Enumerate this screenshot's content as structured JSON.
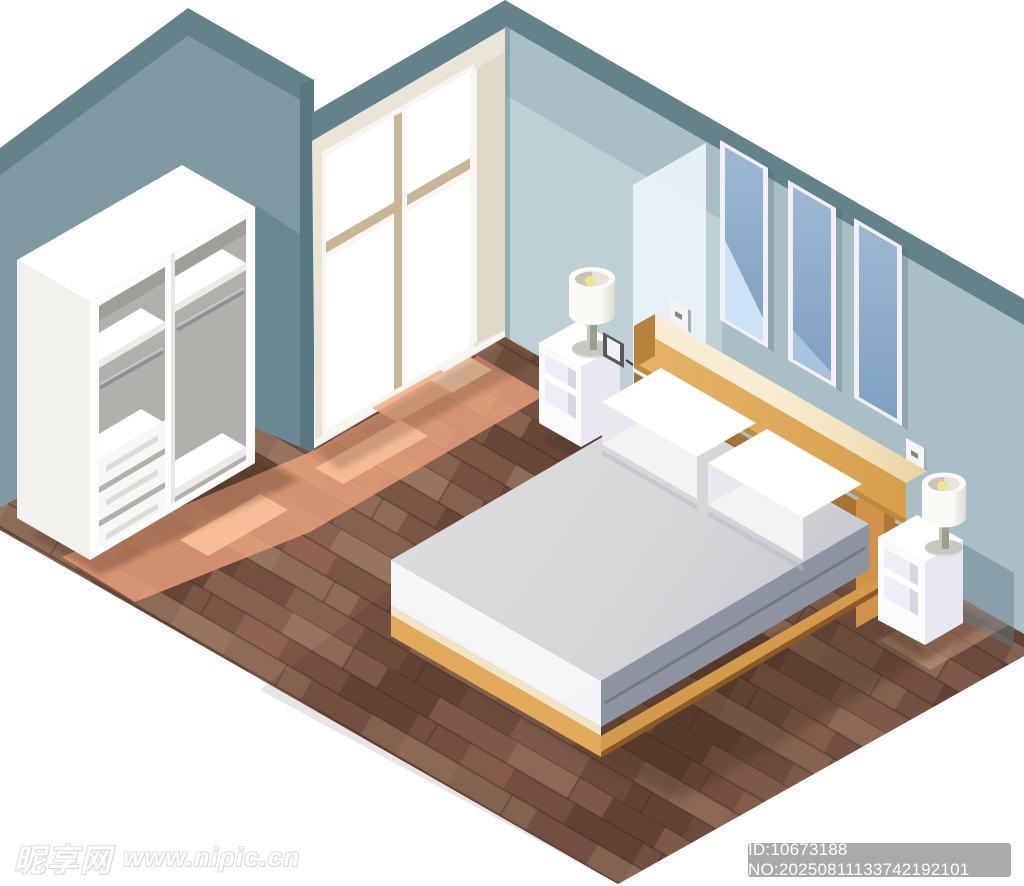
{
  "watermark": {
    "site_name": "昵享网",
    "site_url": "www.nipic.cn"
  },
  "badge": {
    "text": "ID:10673188 NO:20250811133742192101"
  },
  "palette": {
    "wall_dark": "#64828a",
    "wall_mid": "#7e99a1",
    "wall_mid_shadow": "#698893",
    "wall_edge": "#5a7882",
    "wall_right": "#a9bec5",
    "wall_right_light": "#c3d4d9",
    "wall_bright": "#e9f3f8",
    "wall_shadow": "#5e7d88",
    "window_cream": "#ebe5d8",
    "window_cream_dark": "#e0d9c9",
    "window_tan": "#c9b698",
    "white": "#ffffff",
    "off_white": "#f8f6f1",
    "frame_border": "#f1eff9",
    "glass_top": "#9db8d2",
    "glass_bottom": "#7fa0c2",
    "glass_sky": "#cbe3f5",
    "floor_base": "#7d594a",
    "plank_a": "#86614f",
    "plank_b": "#7a5645",
    "plank_c": "#8e6b57",
    "plank_d": "#745140",
    "plank_light": "#97745e",
    "plank_dark": "#684738",
    "plank_red": "#8f6350",
    "sun": "#efa47d",
    "sun_light": "#f7c29b",
    "wr_white": "#fdfdfc",
    "wr_side": "#f2f1ee",
    "wr_interior": "#b2b0ad",
    "wr_interior_dark": "#a09e9b",
    "wr_line": "#dedcd8",
    "rail_gray": "#8e9296",
    "mattress_top": "#d5d6d8",
    "mattress_front": "#f4f4f6",
    "mattress_side": "#8e93a2",
    "mattress_fold": "#6f7584",
    "wood_top": "#f2e3bd",
    "wood_top_light": "#f8edd3",
    "wood_front": "#e5b469",
    "wood_front_dark": "#d89f4c",
    "wood_side": "#b8813c",
    "wood_rail": "#a87434",
    "wood_dark": "#7d5222",
    "base_lip": "#f3e5c2",
    "base_tan": "#e2a95b",
    "base_tan_side": "#d49a4c",
    "base_dark": "#8a5a28",
    "leg": "#d09148",
    "leg_side": "#b07634",
    "ns_top": "#ffffff",
    "ns_face": "#fbfbfd",
    "ns_side": "#e9e7f2",
    "ns_interior": "#efeef5",
    "ns_interior_dark": "#d8d5e5",
    "lamp_white": "#fbfaf7",
    "lamp_shade_dark": "#dedacf",
    "lamp_inner": "#e8e4d8",
    "bulb": "#ece592",
    "stem": "#9aa08f",
    "lamp_base": "#d9d8d2",
    "pillow_top": "#ffffff",
    "pillow_front": "#f3f3f6",
    "pillow_side": "#e8e8ee",
    "photo_dark": "#58585c",
    "shadow_dark": "#3f2a1e",
    "badge_bg": "#9e9e9e"
  }
}
